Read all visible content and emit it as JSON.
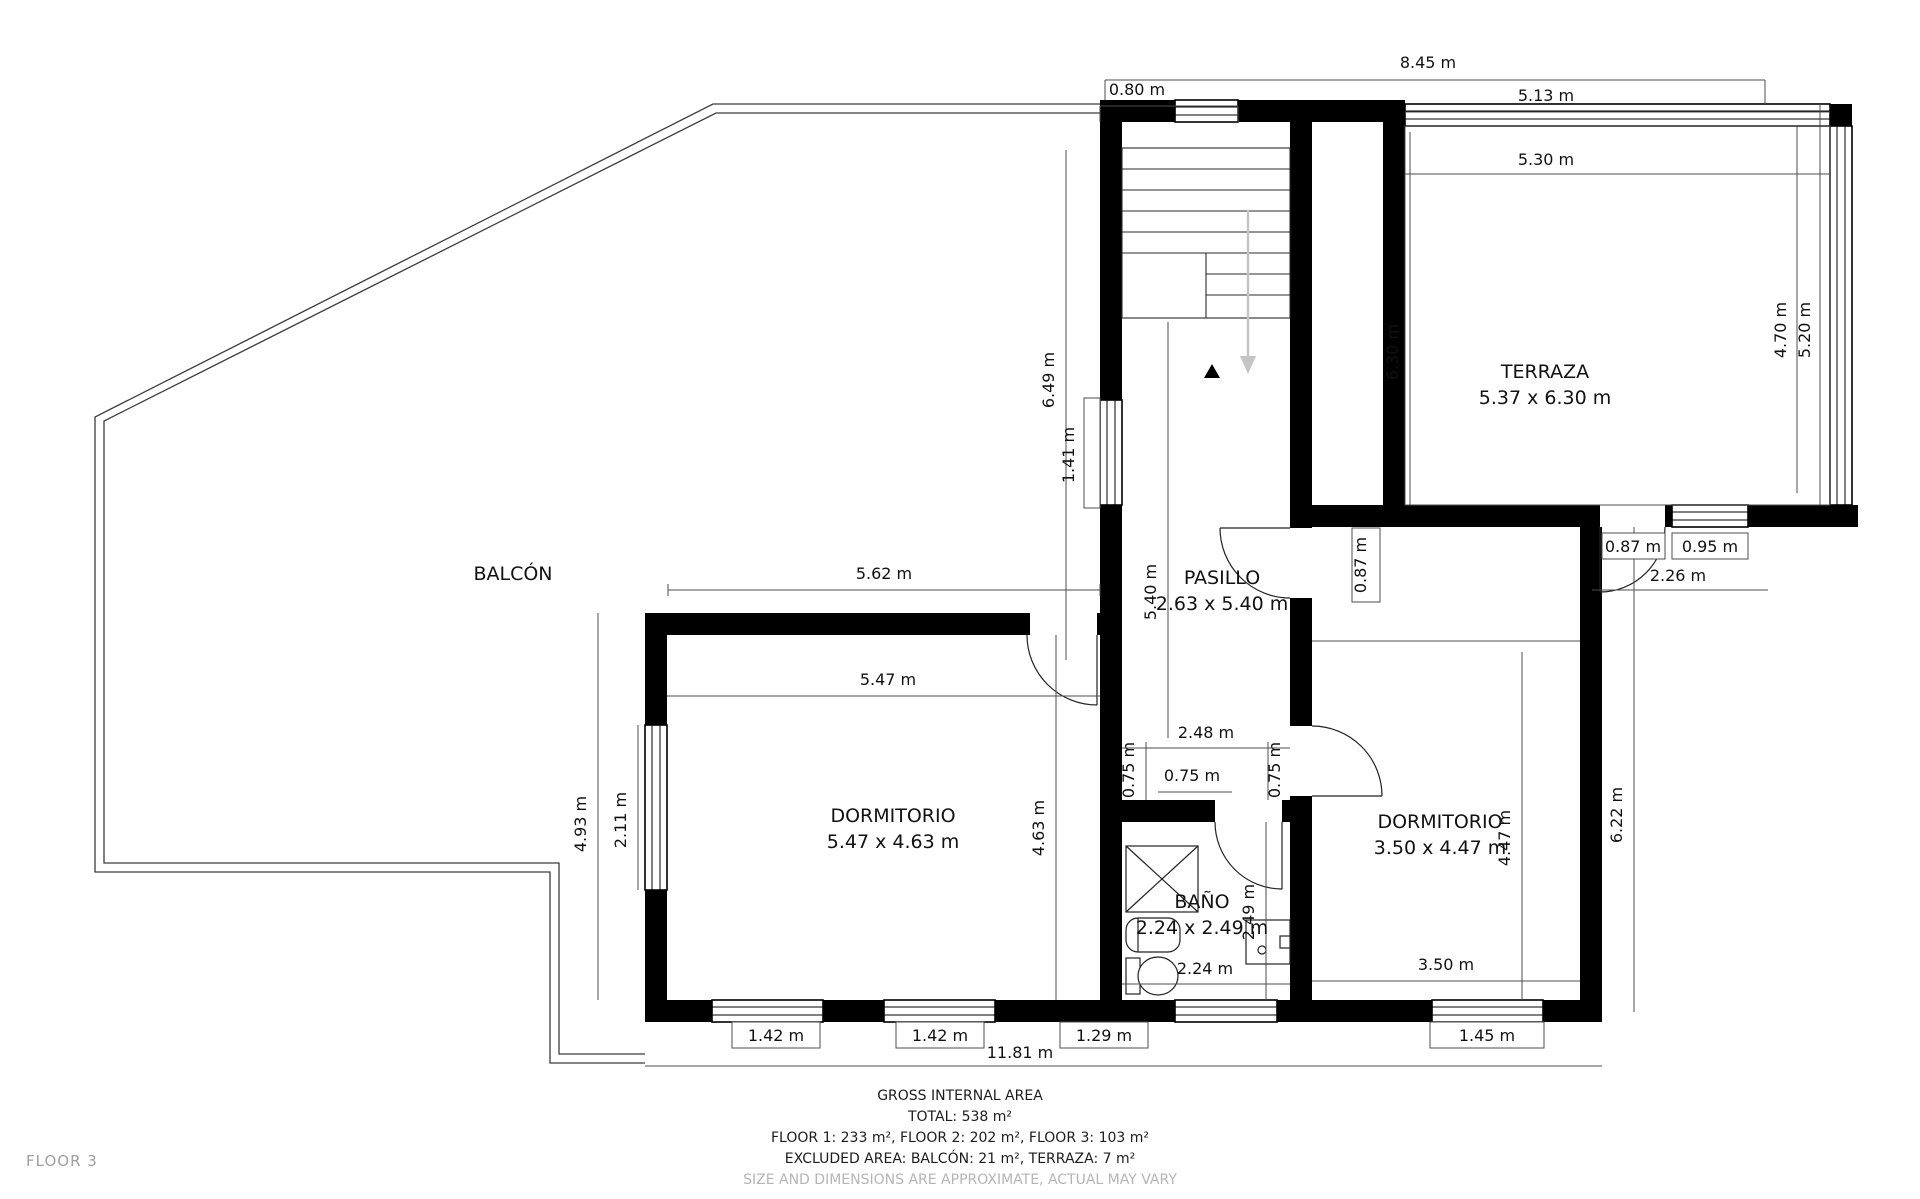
{
  "title": "Floor plan — Floor 3",
  "floor_label": "FLOOR 3",
  "colors": {
    "wall": "#000000",
    "dim_line": "#4d4d4d",
    "text": "#111111",
    "muted_text": "#b5b5b5",
    "floor_tag": "#9f9f9f",
    "stairs_arrow": "#c4c4c4"
  },
  "rooms": [
    {
      "name": "room-label-balcon",
      "label": "BALCÓN",
      "size": "",
      "x": 513,
      "y": 580
    },
    {
      "name": "room-label-terraza",
      "label": "TERRAZA",
      "size": "5.37 x 6.30 m",
      "x": 1545,
      "y": 378
    },
    {
      "name": "room-label-pasillo",
      "label": "PASILLO",
      "size": "2.63 x 5.40 m",
      "x": 1222,
      "y": 584
    },
    {
      "name": "room-label-dormitorio-left",
      "label": "DORMITORIO",
      "size": "5.47 x 4.63 m",
      "x": 893,
      "y": 822
    },
    {
      "name": "room-label-bano",
      "label": "BAÑO",
      "size": "2.24 x 2.49 m",
      "x": 1202,
      "y": 908
    },
    {
      "name": "room-label-dormitorio-right",
      "label": "DORMITORIO",
      "size": "3.50 x 4.47 m",
      "x": 1440,
      "y": 828
    }
  ],
  "dimensions": {
    "horizontal": [
      {
        "t": "8.45 m",
        "x": 1428,
        "y": 68
      },
      {
        "t": "0.80 m",
        "x": 1137,
        "y": 95
      },
      {
        "t": "5.13 m",
        "x": 1546,
        "y": 101
      },
      {
        "t": "5.30 m",
        "x": 1546,
        "y": 165
      },
      {
        "t": "5.62 m",
        "x": 884,
        "y": 579
      },
      {
        "t": "5.47 m",
        "x": 888,
        "y": 685
      },
      {
        "t": "2.48 m",
        "x": 1206,
        "y": 738
      },
      {
        "t": "0.75 m",
        "x": 1192,
        "y": 781
      },
      {
        "t": "0.87 m",
        "x": 1633,
        "y": 552
      },
      {
        "t": "0.95 m",
        "x": 1710,
        "y": 552
      },
      {
        "t": "2.26 m",
        "x": 1678,
        "y": 581
      },
      {
        "t": "2.24 m",
        "x": 1205,
        "y": 974
      },
      {
        "t": "3.50 m",
        "x": 1446,
        "y": 970
      },
      {
        "t": "1.42 m",
        "x": 776,
        "y": 1041
      },
      {
        "t": "1.42 m",
        "x": 940,
        "y": 1041
      },
      {
        "t": "1.29 m",
        "x": 1104,
        "y": 1041
      },
      {
        "t": "1.45 m",
        "x": 1487,
        "y": 1041
      },
      {
        "t": "11.81 m",
        "x": 1020,
        "y": 1058
      }
    ],
    "vertical": [
      {
        "t": "6.49 m",
        "x": 1054,
        "y": 380
      },
      {
        "t": "1.41 m",
        "x": 1074,
        "y": 455
      },
      {
        "t": "5.40 m",
        "x": 1156,
        "y": 592
      },
      {
        "t": "6.30 m",
        "x": 1398,
        "y": 352
      },
      {
        "t": "4.70 m",
        "x": 1786,
        "y": 330
      },
      {
        "t": "5.20 m",
        "x": 1810,
        "y": 330
      },
      {
        "t": "0.87 m",
        "x": 1366,
        "y": 565
      },
      {
        "t": "4.93 m",
        "x": 586,
        "y": 824
      },
      {
        "t": "2.11 m",
        "x": 626,
        "y": 820
      },
      {
        "t": "4.63 m",
        "x": 1044,
        "y": 828
      },
      {
        "t": "0.75 m",
        "x": 1134,
        "y": 770
      },
      {
        "t": "0.75 m",
        "x": 1280,
        "y": 770
      },
      {
        "t": "2.49 m",
        "x": 1254,
        "y": 912
      },
      {
        "t": "4.47 m",
        "x": 1510,
        "y": 838
      },
      {
        "t": "6.22 m",
        "x": 1622,
        "y": 815
      }
    ]
  },
  "footer": {
    "line1": "GROSS INTERNAL AREA",
    "line2": "TOTAL: 538 m²",
    "line3": "FLOOR 1: 233 m², FLOOR 2: 202 m², FLOOR 3: 103 m²",
    "line4": "EXCLUDED AREA: BALCÓN: 21 m², TERRAZA: 7 m²",
    "line5": "SIZE AND DIMENSIONS ARE APPROXIMATE, ACTUAL MAY VARY"
  }
}
